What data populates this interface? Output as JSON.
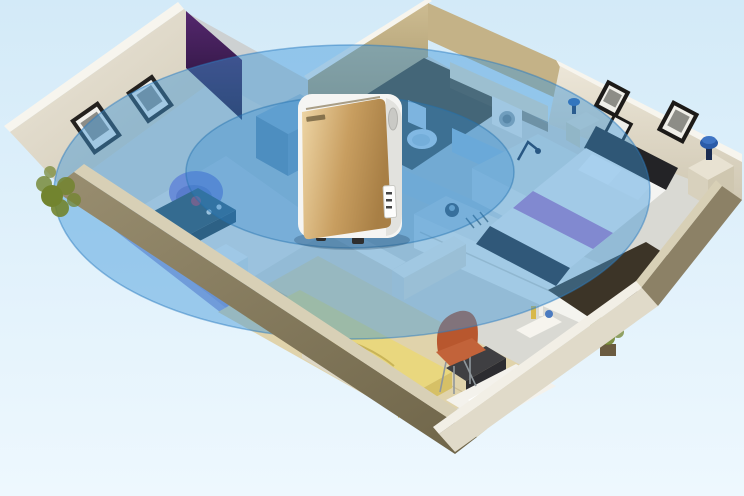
{
  "scene": {
    "type": "isometric-floor-plan-render",
    "subject": "Air purifier standing in the middle of a cutaway apartment model with translucent blue ellipses showing its purification coverage radius",
    "rooms": [
      "living-room",
      "bathroom",
      "kitchen",
      "master-bedroom",
      "second-bedroom",
      "study-corner"
    ],
    "objects": [
      "air-purifier",
      "coverage-ring-outer",
      "coverage-ring-inner",
      "sofa",
      "armchair",
      "coffee-table",
      "wall-frames",
      "toilet",
      "washing-machine",
      "kitchen-counter",
      "sink",
      "double-bed",
      "nightstand-lamps",
      "yellow-single-bed",
      "orange-chair",
      "desk",
      "potted-plants",
      "dark-rug"
    ]
  },
  "palette": {
    "background_top": "#d3eaf8",
    "background_bottom": "#eef8fe",
    "coverage_blue": "#3f96d9",
    "coverage_inner_blue": "#2f86cc",
    "coverage_edge": "#2b7bc0",
    "purifier_gold": "#cda96f",
    "purifier_body": "#f5f5f3",
    "wall_cream": "#e4ddcd",
    "wall_top_edge": "#f7f5ee",
    "wall_outer_olive": "#8c8166",
    "wall_accent_purple": "#44205e",
    "bathroom_tan": "#c4b287",
    "bathroom_floor_dark": "#4a3e28",
    "floor_light": "#d9d9d3",
    "floor_wood": "#e0d3ab",
    "rug_light": "#e8e7e3",
    "rug_dark": "#3c3427",
    "sofa_lavender": "#8a90d2",
    "armchair_purple": "#8d85d8",
    "coffee_table_teal": "#2c4854",
    "bed_linen_white": "#f4f4f2",
    "bed_frame_dark": "#232326",
    "bed_runner_purple": "#b273c4",
    "bed_yellow": "#e9d77e",
    "chair_orange": "#c2633a",
    "lamp_blue": "#2a5ba8",
    "plant_green": "#72842f",
    "shadow_blue": "#1c3c5a"
  }
}
